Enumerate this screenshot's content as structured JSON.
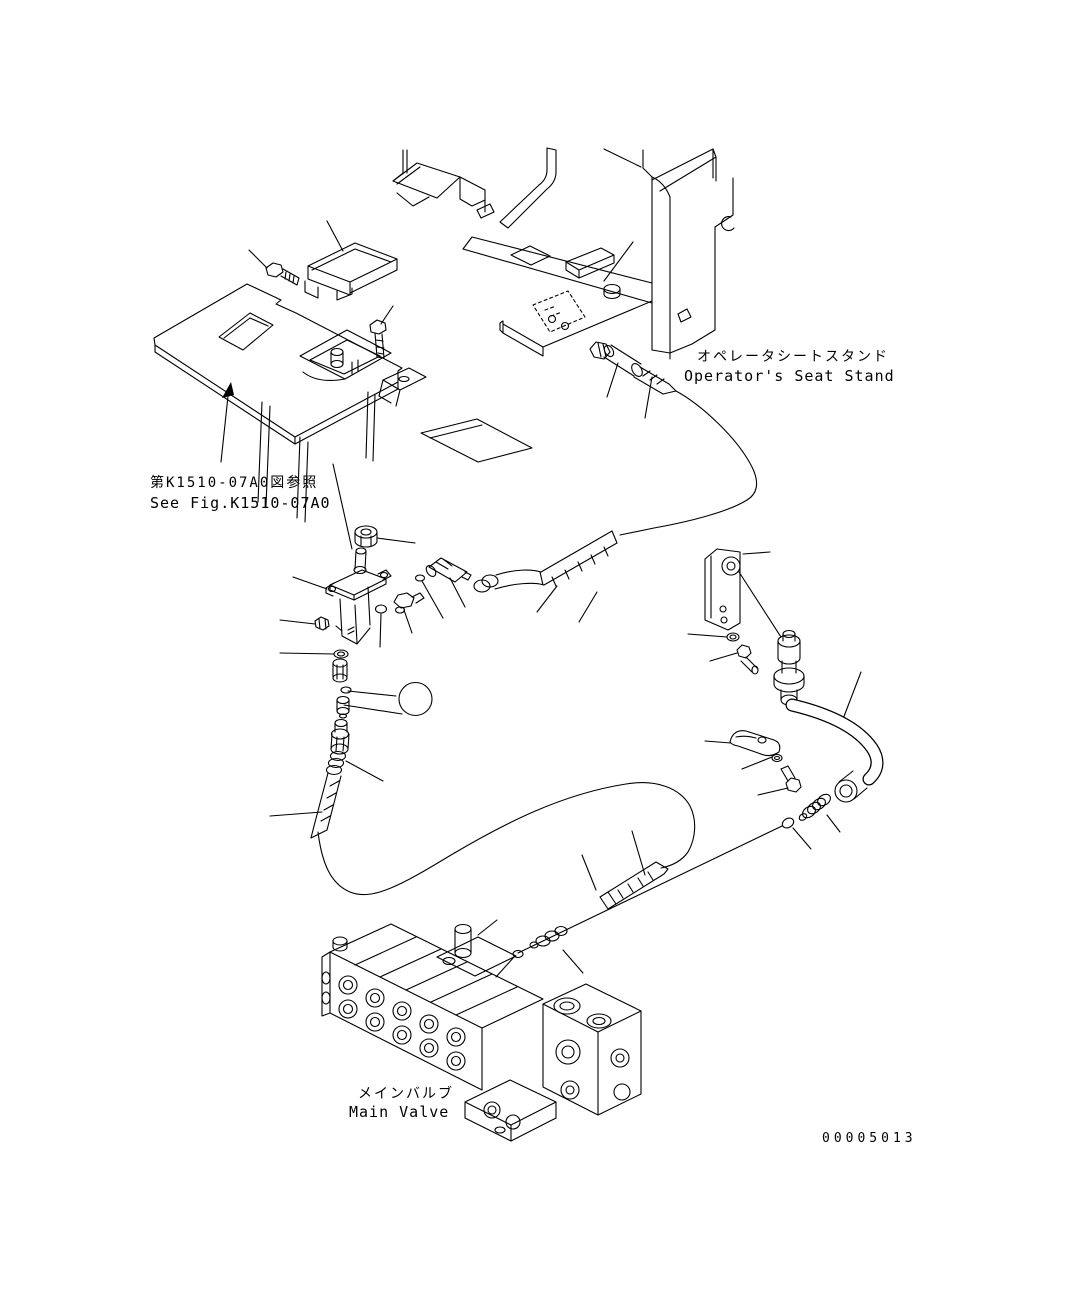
{
  "figure": {
    "drawing_number": "00005013",
    "callout": {
      "number": "13"
    },
    "reference_note": {
      "jp": "第K1510-07A0図参照",
      "en": "See Fig.K1510-07A0"
    },
    "seat_stand_label": {
      "jp": "オペレータシートスタンド",
      "en": "Operator's Seat Stand"
    },
    "main_valve_label": {
      "jp": "メインバルブ",
      "en": "Main Valve"
    },
    "colors": {
      "background": "#ffffff",
      "line_color": "#000000",
      "callout_fill": "#0a7e0a",
      "callout_ring": "#000000",
      "callout_text": "#ffffff"
    }
  }
}
